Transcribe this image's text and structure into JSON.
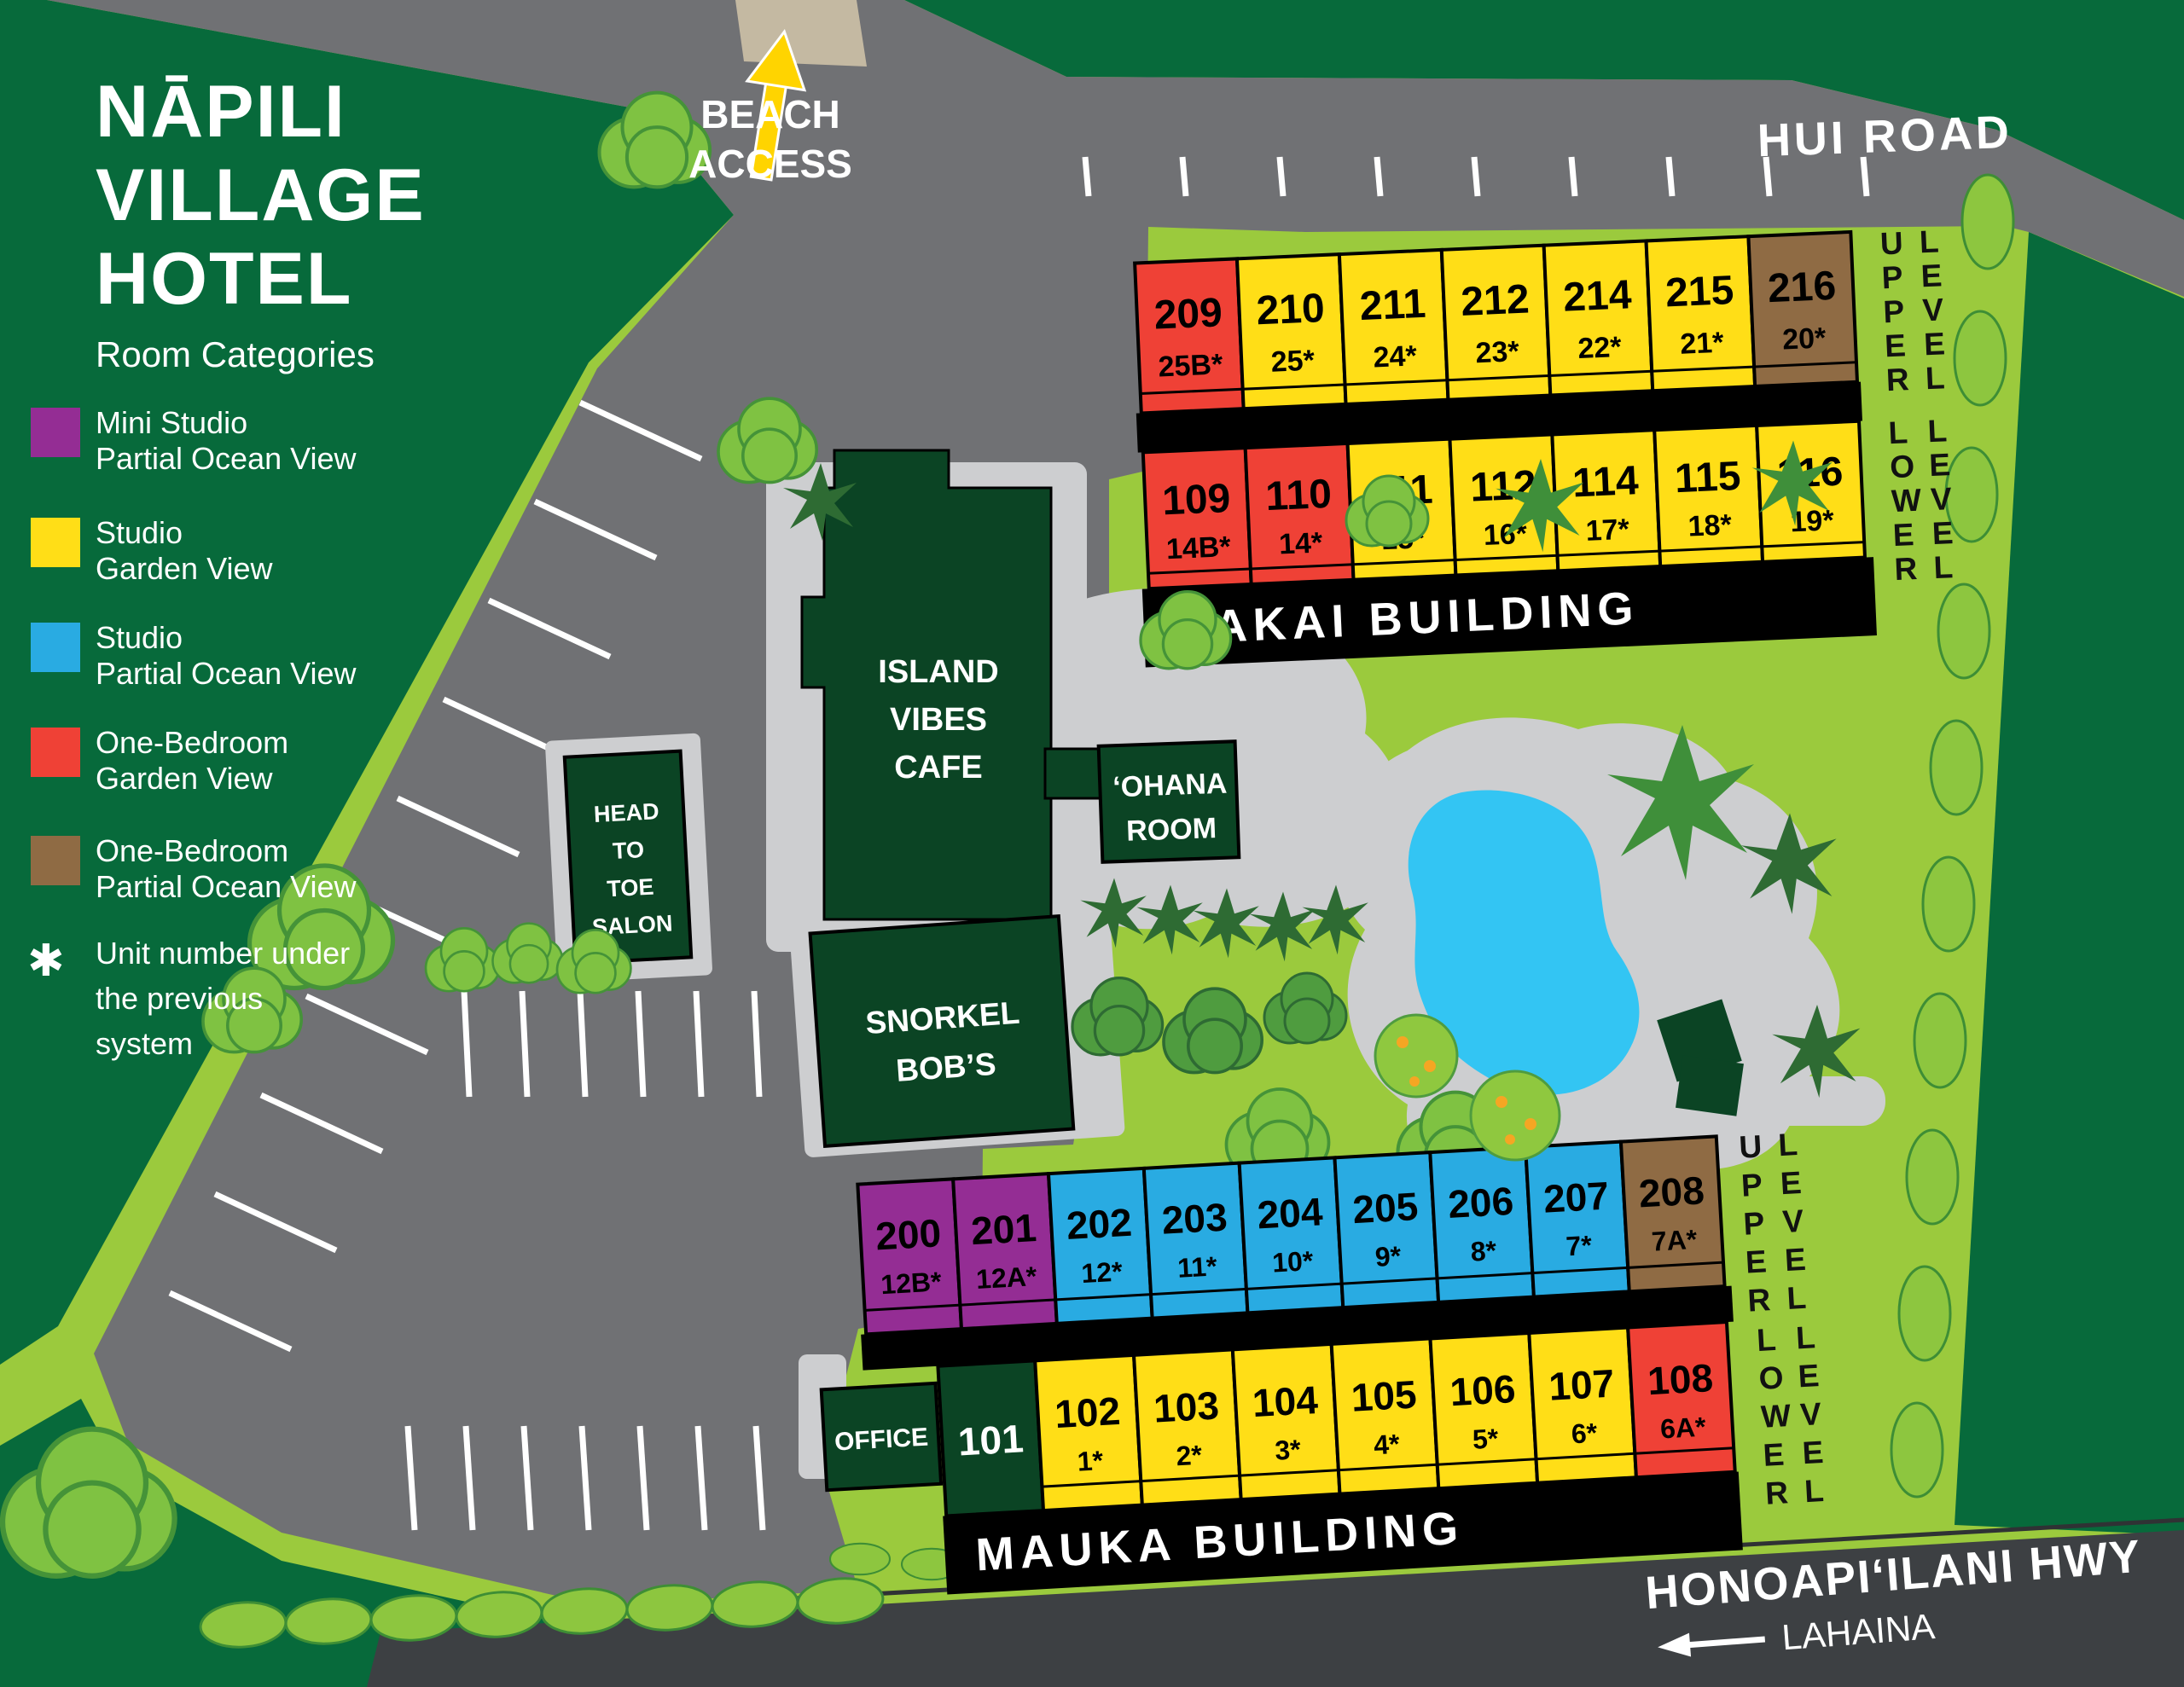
{
  "title": {
    "line1": "NĀPILI",
    "line2": "VILLAGE",
    "line3": "HOTEL",
    "subtitle": "Room Categories"
  },
  "legend": {
    "items": [
      {
        "color": "#942d94",
        "line1": "Mini Studio",
        "line2": "Partial Ocean View"
      },
      {
        "color": "#ffde17",
        "line1": "Studio",
        "line2": "Garden View"
      },
      {
        "color": "#29abe2",
        "line1": "Studio",
        "line2": "Partial Ocean View"
      },
      {
        "color": "#ef4136",
        "line1": "One-Bedroom",
        "line2": "Garden View"
      },
      {
        "color": "#8f6b44",
        "line1": "One-Bedroom",
        "line2": "Partial Ocean View"
      }
    ],
    "note_symbol": "✱",
    "note_line1": "Unit number under",
    "note_line2": "the previous",
    "note_line3": "system"
  },
  "roads": {
    "hui_road": "HUI ROAD",
    "beach_line1": "BEACH",
    "beach_line2": "ACCESS",
    "highway": "HONOAPI‘ILANI HWY",
    "highway_direction": "LAHAINA"
  },
  "places": {
    "cafe_line1": "ISLAND",
    "cafe_line2": "VIBES",
    "cafe_line3": "CAFE",
    "salon_line1": "HEAD",
    "salon_line2": "TO",
    "salon_line3": "TOE",
    "salon_line4": "SALON",
    "snorkel_line1": "SNORKEL",
    "snorkel_line2": "BOB’S",
    "ohana_line1": "‘OHANA",
    "ohana_line2": "ROOM",
    "office": "OFFICE"
  },
  "levels": {
    "upper": "UPPER",
    "lower": "LOWER",
    "level": "LEVEL"
  },
  "makai": {
    "name": "MAKAI BUILDING",
    "upper": [
      {
        "number": "209",
        "old": "25B*",
        "color": "#ef4136"
      },
      {
        "number": "210",
        "old": "25*",
        "color": "#ffde17"
      },
      {
        "number": "211",
        "old": "24*",
        "color": "#ffde17"
      },
      {
        "number": "212",
        "old": "23*",
        "color": "#ffde17"
      },
      {
        "number": "214",
        "old": "22*",
        "color": "#ffde17"
      },
      {
        "number": "215",
        "old": "21*",
        "color": "#ffde17"
      },
      {
        "number": "216",
        "old": "20*",
        "color": "#8f6b44"
      }
    ],
    "lower": [
      {
        "number": "109",
        "old": "14B*",
        "color": "#ef4136"
      },
      {
        "number": "110",
        "old": "14*",
        "color": "#ef4136"
      },
      {
        "number": "111",
        "old": "15*",
        "color": "#ffde17"
      },
      {
        "number": "112",
        "old": "16*",
        "color": "#ffde17"
      },
      {
        "number": "114",
        "old": "17*",
        "color": "#ffde17"
      },
      {
        "number": "115",
        "old": "18*",
        "color": "#ffde17"
      },
      {
        "number": "116",
        "old": "19*",
        "color": "#ffde17"
      }
    ]
  },
  "mauka": {
    "name": "MAUKA BUILDING",
    "room101": "101",
    "upper": [
      {
        "number": "200",
        "old": "12B*",
        "color": "#942d94"
      },
      {
        "number": "201",
        "old": "12A*",
        "color": "#942d94"
      },
      {
        "number": "202",
        "old": "12*",
        "color": "#29abe2"
      },
      {
        "number": "203",
        "old": "11*",
        "color": "#29abe2"
      },
      {
        "number": "204",
        "old": "10*",
        "color": "#29abe2"
      },
      {
        "number": "205",
        "old": "9*",
        "color": "#29abe2"
      },
      {
        "number": "206",
        "old": "8*",
        "color": "#29abe2"
      },
      {
        "number": "207",
        "old": "7*",
        "color": "#29abe2"
      },
      {
        "number": "208",
        "old": "7A*",
        "color": "#8f6b44"
      }
    ],
    "lower": [
      {
        "number": "102",
        "old": "1*",
        "color": "#ffde17"
      },
      {
        "number": "103",
        "old": "2*",
        "color": "#ffde17"
      },
      {
        "number": "104",
        "old": "3*",
        "color": "#ffde17"
      },
      {
        "number": "105",
        "old": "4*",
        "color": "#ffde17"
      },
      {
        "number": "106",
        "old": "5*",
        "color": "#ffde17"
      },
      {
        "number": "107",
        "old": "6*",
        "color": "#ffde17"
      },
      {
        "number": "108",
        "old": "6A*",
        "color": "#ef4136"
      }
    ]
  },
  "colors": {
    "background_dark_green": "#076a3b",
    "property_green": "#9bca3d",
    "road_gray": "#707174",
    "walkway_gray": "#cdced0",
    "highway_gray": "#3d4043",
    "beach_path_tan": "#c4b9a2",
    "pool_blue": "#33c5f3",
    "building_dark_green": "#0b4424",
    "banner_black": "#000000",
    "arrow_yellow": "#ffd400"
  }
}
